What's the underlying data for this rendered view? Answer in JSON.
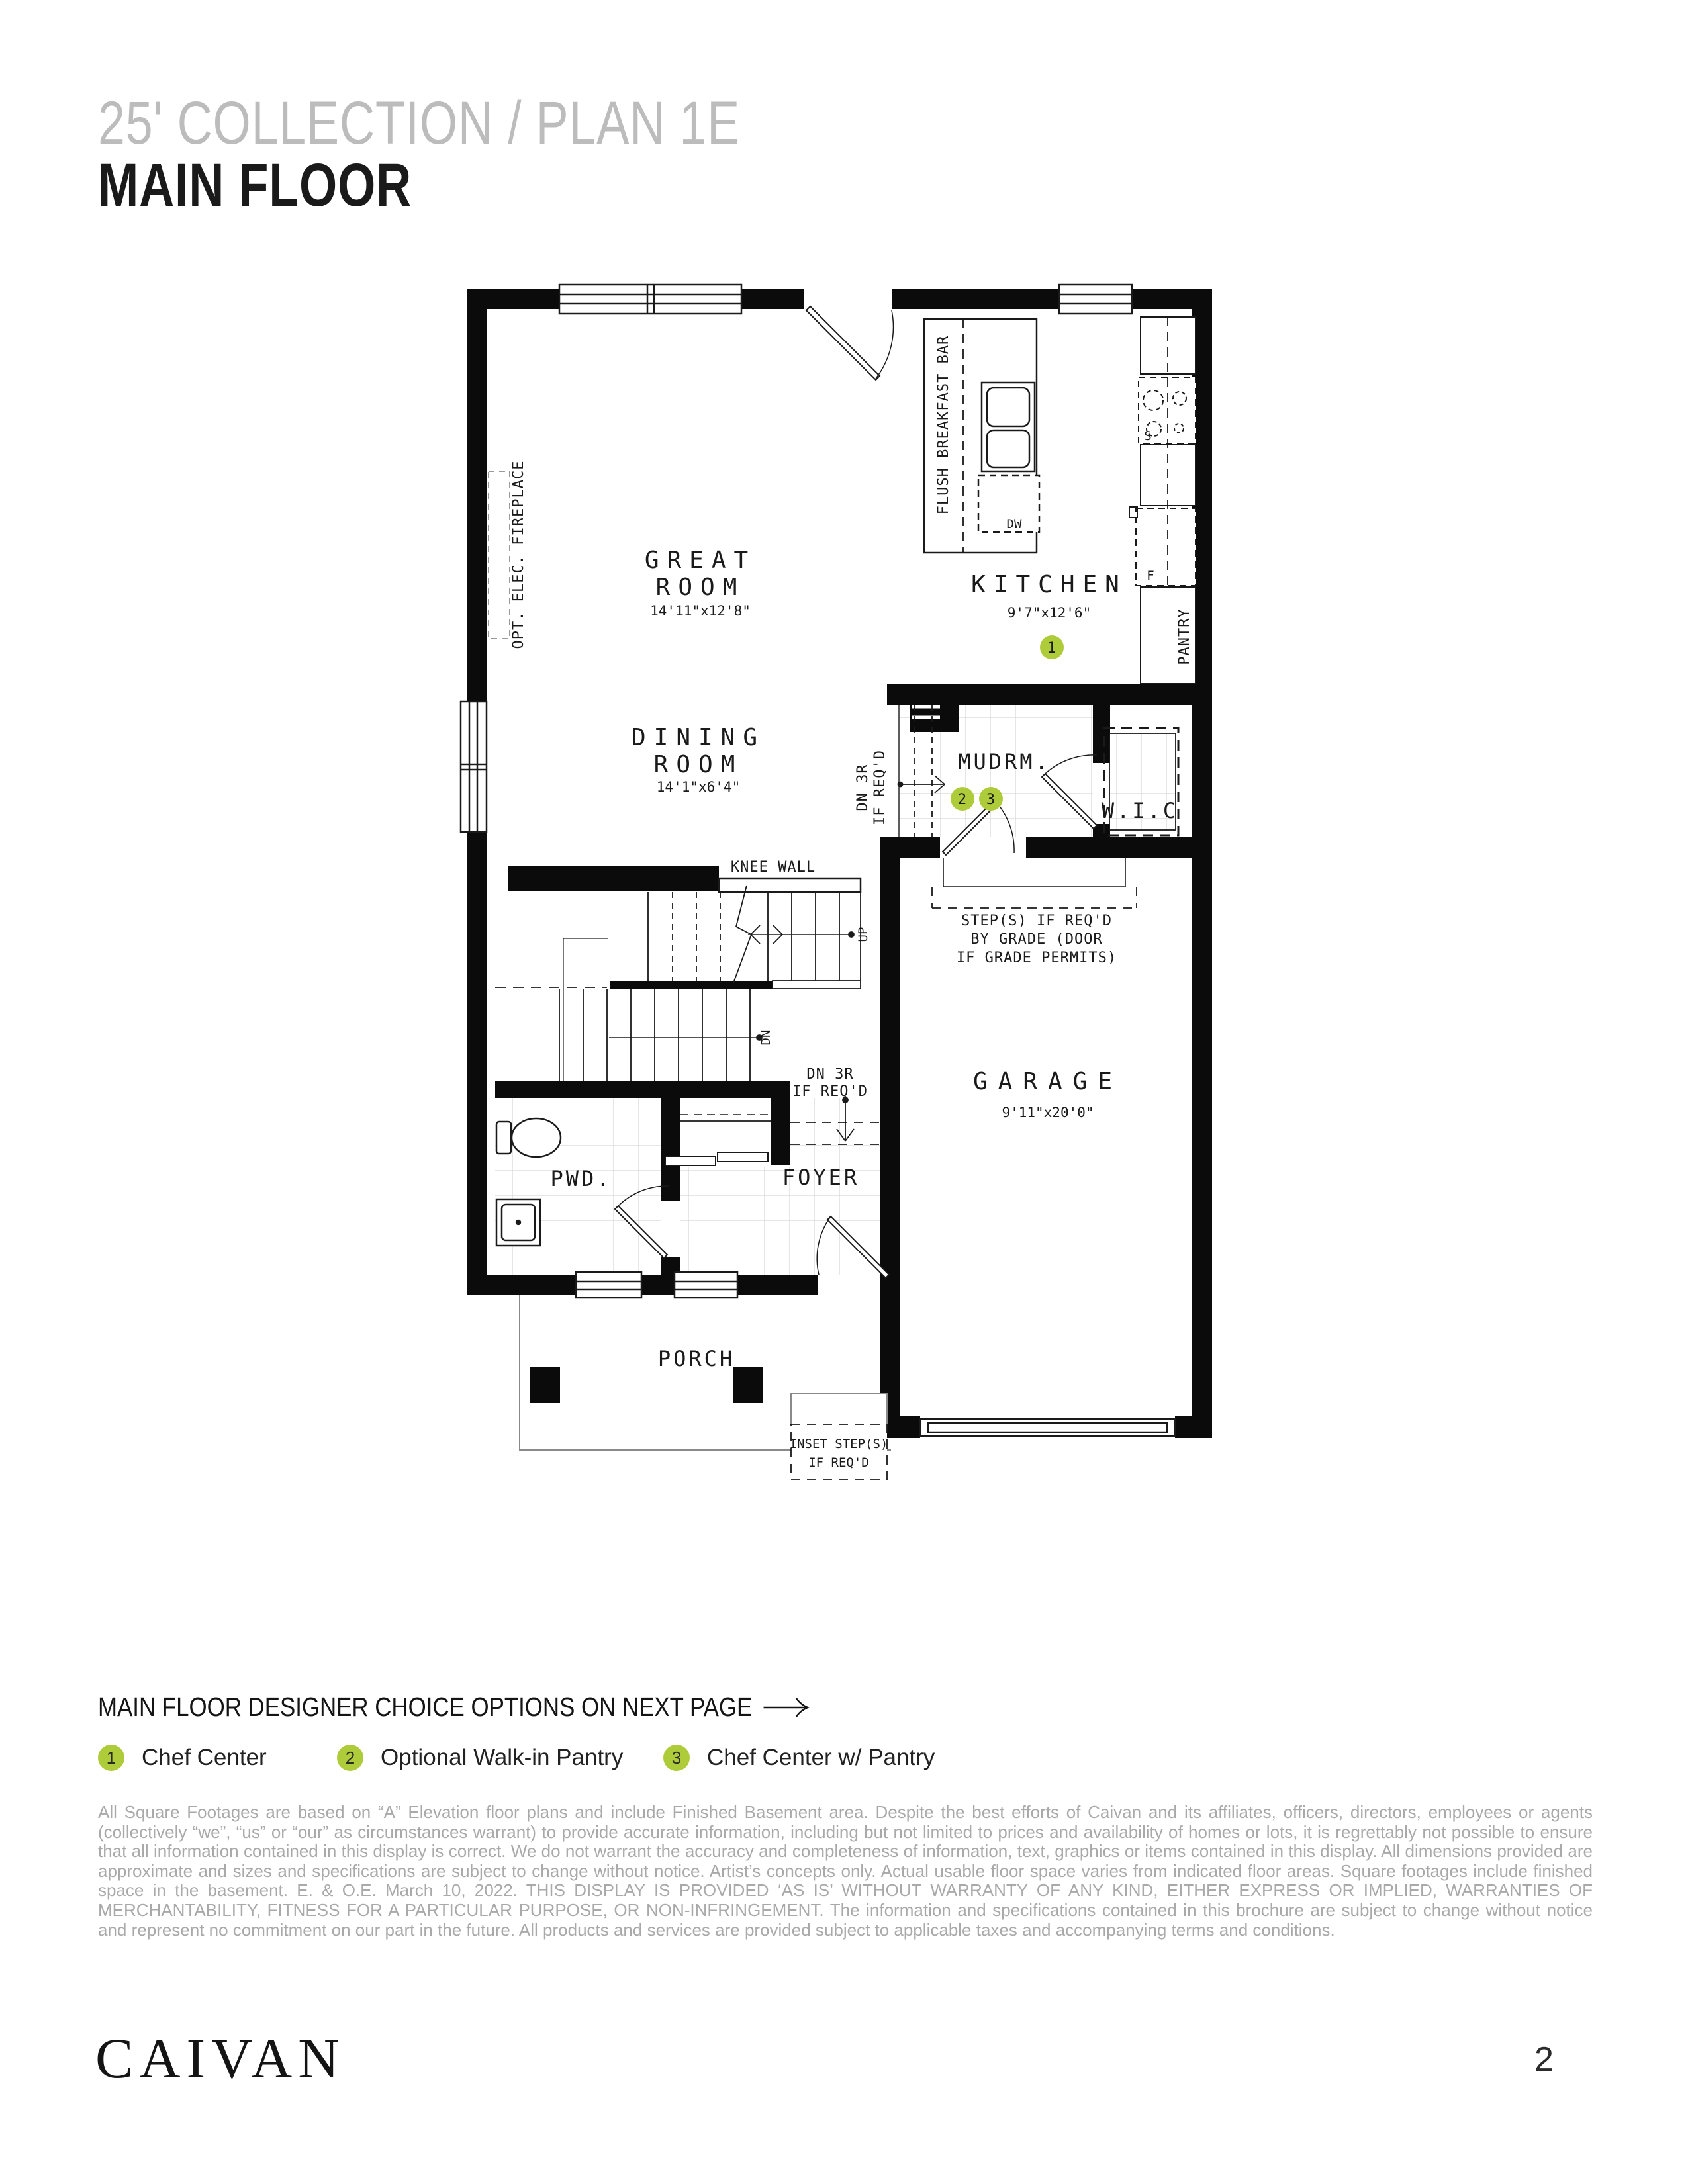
{
  "header": {
    "collection": "25' COLLECTION / PLAN 1E",
    "floor": "MAIN FLOOR"
  },
  "plan": {
    "rooms": {
      "great_room": {
        "l1": "GREAT",
        "l2": "ROOM",
        "dims": "14'11\"x12'8\""
      },
      "dining_room": {
        "l1": "DINING",
        "l2": "ROOM",
        "dims": "14'1\"x6'4\""
      },
      "kitchen": {
        "l1": "KITCHEN",
        "dims": "9'7\"x12'6\""
      },
      "mudroom": {
        "l1": "MUDRM."
      },
      "wic": {
        "l1": "W.I.C"
      },
      "garage": {
        "l1": "GARAGE",
        "dims": "9'11\"x20'0\""
      },
      "powder": {
        "l1": "PWD."
      },
      "foyer": {
        "l1": "FOYER"
      },
      "porch": {
        "l1": "PORCH"
      }
    },
    "annotations": {
      "opt_fireplace": "OPT. ELEC. FIREPLACE",
      "flush_bar": "FLUSH BREAKFAST BAR",
      "pantry": "PANTRY",
      "knee_wall": "KNEE WALL",
      "dn3r_1": "DN 3R",
      "dn3r_2": "IF REQ'D",
      "steps_1": "STEP(S) IF REQ'D",
      "steps_2": "BY GRADE (DOOR",
      "steps_3": "IF GRADE PERMITS)",
      "inset_1": "INSET STEP(S)",
      "inset_2": "IF REQ'D",
      "up": "UP",
      "dn": "DN",
      "dw": "DW",
      "stove": "S",
      "fridge": "F"
    }
  },
  "options": {
    "heading": "MAIN FLOOR DESIGNER CHOICE OPTIONS ON NEXT PAGE",
    "legend": [
      {
        "num": "1",
        "label": "Chef Center"
      },
      {
        "num": "2",
        "label": "Optional Walk-in Pantry"
      },
      {
        "num": "3",
        "label": "Chef Center w/ Pantry"
      }
    ]
  },
  "disclaimer": "All Square Footages are based on “A” Elevation floor plans and include Finished Basement area. Despite the best efforts of Caivan and its affiliates, officers, directors, employees or agents (collectively “we”, “us” or “our” as circumstances warrant) to provide accurate information, including but not limited to prices and availability of homes or lots, it is regrettably not possible to ensure that all information contained in this display is correct. We do not warrant the accuracy and completeness of information, text, graphics or items contained in this display. All dimensions provided are approximate and sizes and specifications are subject to change without notice. Artist’s concepts only. Actual usable floor space varies from indicated floor areas. Square footages include finished space in the basement. E. & O.E. March 10, 2022. THIS DISPLAY IS PROVIDED ‘AS IS’ WITHOUT WARRANTY OF ANY KIND, EITHER EXPRESS OR IMPLIED, WARRANTIES OF MERCHANTABILITY, FITNESS FOR A PARTICULAR PURPOSE, OR NON-INFRINGEMENT. The information and specifications contained in this brochure are subject to change without notice and represent no commitment on our part in the future. All products and services are provided subject to applicable taxes and accompanying terms and conditions.",
  "footer": {
    "brand": "CAIVAN",
    "page": "2"
  },
  "colors": {
    "accent_green": "#aecb3a",
    "title_gray": "#bcbcbc",
    "muted_text": "#a9a9a9",
    "line_black": "#1a1a1a"
  }
}
